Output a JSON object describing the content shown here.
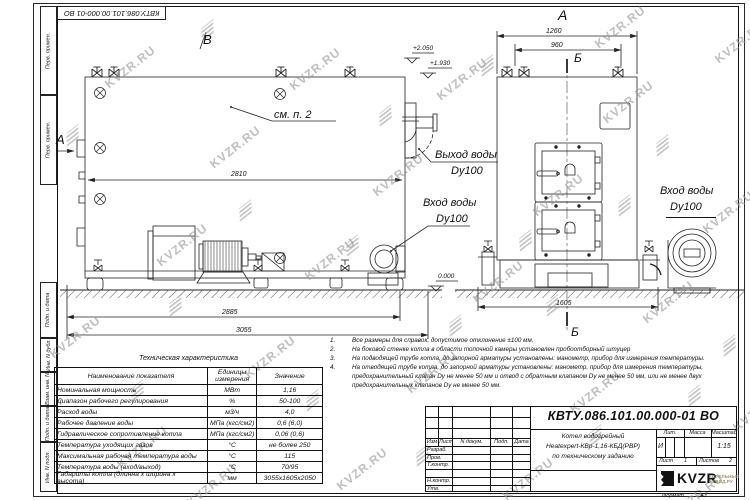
{
  "stamp_top": "КВТУ.086.101.00.000-01 ВО",
  "margin_boxes": [
    "Перв. примен.",
    "Перв. примен.",
    "Подп. и дата",
    "Инв. N дубл.",
    "Взам. инв. N",
    "Подп. и дата",
    "Инв. N подл."
  ],
  "watermark": {
    "text": "KVZR.RU"
  },
  "drawing": {
    "view_b_label": "В",
    "view_a_arrow_label": "А",
    "front_view_label": "А",
    "see_note": "см. п. 2",
    "dim_2810": "2810",
    "dim_2885": "2885",
    "dim_3055": "3055",
    "dim_1260": "1260",
    "dim_960": "960",
    "dim_1605": "1605",
    "section_label_top": "Б",
    "section_label_bottom": "Б",
    "elev_high": "+2.050",
    "elev_mid": "+1.930",
    "elev_zero": "0.000",
    "outlet_label_line1": "Выход воды",
    "outlet_label_line2": "Dy100",
    "inlet_side_label_line1": "Вход воды",
    "inlet_side_label_line2": "Dy100",
    "inlet_front_label_line1": "Вход воды",
    "inlet_front_label_line2": "Dy100"
  },
  "table": {
    "title": "Техническая характеристика",
    "col_name": "Наименование показателя",
    "col_units": "Единицы измерения",
    "col_value": "Значение",
    "rows": [
      [
        "Номинальная мощность",
        "МВт",
        "1,16"
      ],
      [
        "Диапазон рабочего регулирования",
        "%",
        "50-100"
      ],
      [
        "Расход воды",
        "м3/ч",
        "4,0"
      ],
      [
        "Рабочее давление воды",
        "МПа (кгс/см2)",
        "0,6 (6,0)"
      ],
      [
        "Гидравлическое сопротивление котла",
        "МПа (кгс/см2)",
        "0,06 (0,6)"
      ],
      [
        "Температура уходящих газов",
        "°С",
        "не более 250"
      ],
      [
        "Максимальная рабочая температура воды",
        "°С",
        "115"
      ],
      [
        "Температура воды (вход/выход)",
        "°С",
        "70/95"
      ],
      [
        "Габариты котла (длинна х ширина х высота)",
        "мм",
        "3055х1605х2050"
      ]
    ]
  },
  "notes": [
    {
      "n": "1.",
      "text": "Все размеры для справок, допустимое отклонение ±100 мм."
    },
    {
      "n": "2.",
      "text": "На боковой стенке котла в области топочной камеры установлен пробоотборный штуцер"
    },
    {
      "n": "3.",
      "text": "На подводящей трубе котла, до запорной арматуры установлены: манометр, прибор для измерения температуры."
    },
    {
      "n": "4.",
      "text": "На отводящей трубе котла, до запорной арматуры установлены: манометр, прибор для измерения температуры, предохранительный клапан Dу не менее 50 мм и отвод с обратным клапаном Dу не менее 50 мм, или не менее двух предохранительных клапанов Dу не менее 50 мм."
    }
  ],
  "titleblock": {
    "designation": "КВТУ.086.101.00.000-01 ВО",
    "doc_name_line1": "Котел водогрейный",
    "doc_name_line2": "Heatexpert-КВр-1,16-КБД(РВР)",
    "doc_name_line3": "по техническому заданию",
    "header_cols": [
      "Изм",
      "Лист",
      "N докум.",
      "Подп.",
      "Дата"
    ],
    "sign_rows": [
      "Разраб.",
      "Пров.",
      "Т.контр.",
      "Н.контр.",
      "Утв."
    ],
    "lit_label": "Лит.",
    "lit_value": "И",
    "mass_label": "Масса",
    "scale_label": "Масштаб",
    "scale_value": "1:15",
    "sheet_label": "Лист",
    "sheet_value": "1",
    "sheets_label": "Листов",
    "sheets_value": "2",
    "logo_text": "KVZR",
    "logo_sub1": "КОТЕЛЬНЫЙ",
    "logo_sub2": "ЗАВОД.РУ",
    "format_label": "Формат",
    "format_value": "А3"
  }
}
